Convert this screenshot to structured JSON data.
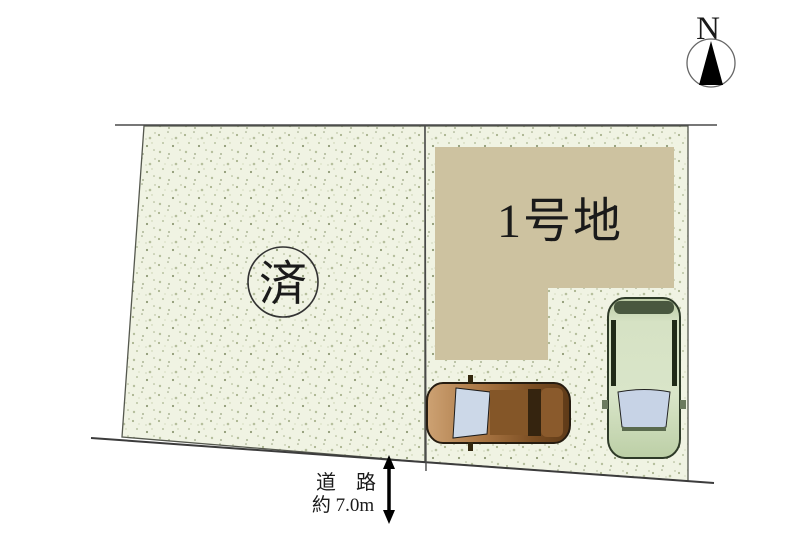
{
  "diagram_title": "land-lot-layout",
  "colors": {
    "background": "#ffffff",
    "parcel_bg": "#f0f3e3",
    "speckle_dark": "#8f9a76",
    "speckle_mid": "#a9b38e",
    "speckle_light": "#c3cca9",
    "building": "#cdc2a0",
    "boundary_line": "#4a4a4a",
    "text": "#1a1a1a",
    "sold_circle_stroke": "#333333",
    "car_brown_body": "#a87442",
    "car_green_body": "#d6e2c4",
    "windshield": "#c9d5e7",
    "arrow": "#000000"
  },
  "compass": {
    "label": "N"
  },
  "parcels": {
    "left": {
      "status_stamp": "済"
    },
    "right": {
      "label": "1号地"
    }
  },
  "road": {
    "label": "道　路",
    "width_label": "約 7.0m"
  }
}
